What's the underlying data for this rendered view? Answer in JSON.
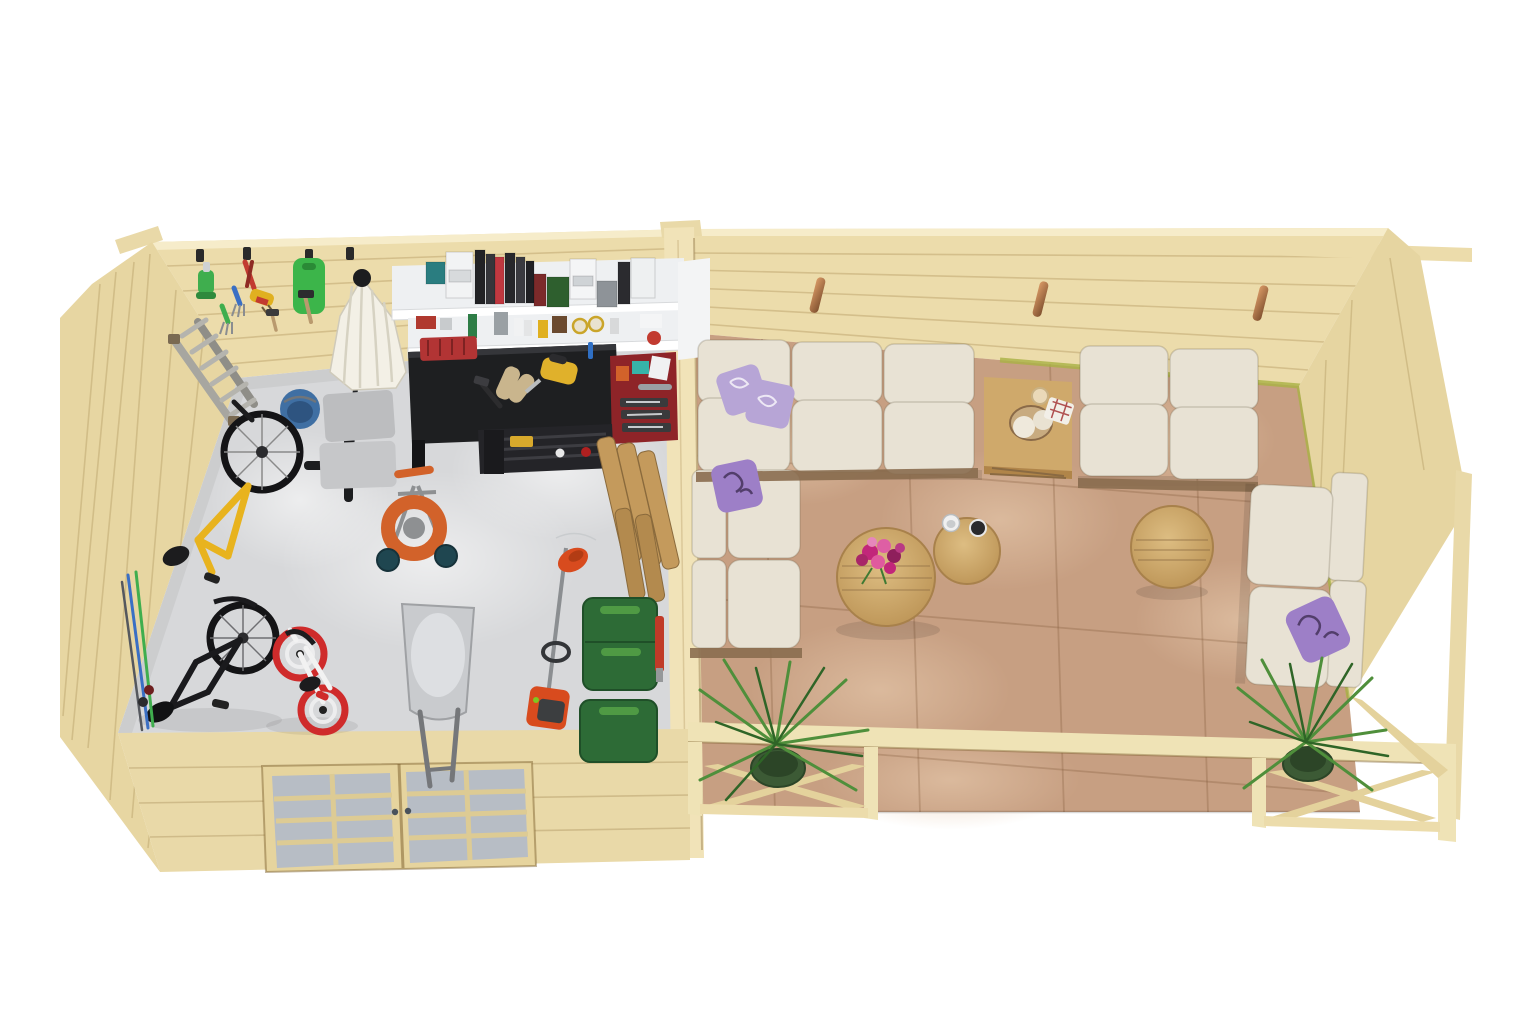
{
  "palette": {
    "bg": "#ffffff",
    "wood": "#ecdcab",
    "wood_top": "#f6ecca",
    "wood_shade": "#e2d09a",
    "wood_dark": "#cdb87e",
    "left_wall": "#e7d6a2",
    "divider": "#f1e3b8",
    "front_wall": "#e9d9a8",
    "gable": "#e6d5a1",
    "rail": "#efe3b6",
    "floor_garage": "#d7d8da",
    "floor_terrace": "#c79f82",
    "tile_mottle": "#dcbc9e",
    "grass": "#a9b244",
    "shelf_white": "#eef0f2",
    "cushion": "#e8e2d4",
    "sofa_frame": "#8a6d4f",
    "pillow_lavender": "#b7a5d6",
    "pillow_floral": "#9d7fc7",
    "pillow_pattern": "#46335c",
    "table_wood": "#cfa96b",
    "table_wood_dark": "#b08549",
    "plant": "#4f8f3b",
    "plant_dark": "#2f6527",
    "pot": "#3c5a35",
    "umbrella": "#f3f0e6",
    "umbrella_fold": "#d6d2c2",
    "dark": "#1e1f21",
    "metal": "#9a9c9e",
    "mat_grey": "#bcbdbf",
    "bucket_blue": "#3f6fa3",
    "crate_red": "#b23434",
    "cabinet_red": "#8e2428",
    "jigsaw_yellow": "#e0b12b",
    "glove_tan": "#c9b58d",
    "hose_orange": "#d2622a",
    "wheel_teal": "#1f4650",
    "bin_green": "#2d6b36",
    "bin_green_light": "#4f9a44",
    "bike_yellow": "#e8b31e",
    "kid_red": "#cf2b2b",
    "barrow_grey": "#c9cbce",
    "trimmer_orange": "#d84b1e",
    "glass": "#b7bdc5",
    "copper": "#b4764a",
    "ladder_grey": "#a7a6a0"
  }
}
